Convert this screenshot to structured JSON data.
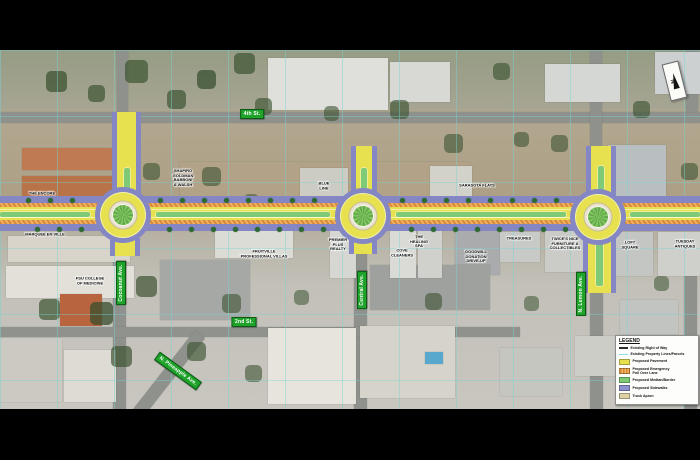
{
  "map": {
    "north_arrow_label": "N",
    "street_labels": [
      "4th St.",
      "2nd St.",
      "Cocoanut Ave.",
      "Central Ave.",
      "N. Lemon Ave.",
      "N. Pineapple Ave."
    ],
    "building_labels": [
      "THE ENCORE",
      "SHAPIRO\nGOLDMAN\nBABBONI\n& WALSH",
      "BLUE\nLINE",
      "SARASOTA FLATS",
      "MARQUEE EN VILLE",
      "FSU COLLEGE\nOF MEDICINE",
      "FRUITVILLE\nPROFESSIONAL VILLAS",
      "PREMIER\nPLUS\nREALTY",
      "COVE\nCLEANERS",
      "THE\nHEALING\nSPA",
      "GOODWILL\nDONATION\nDRIVE-UP",
      "TREASURES",
      "TWICE'S NICE\nFURNITURE &\nCOLLECTIBLES",
      "LOFT\nSQUARE",
      "TUESDAY\nANTIQUES"
    ]
  },
  "legend": {
    "title": "LEGEND",
    "items": [
      {
        "label": "Existing Right of Way",
        "swatch": "right-of-way"
      },
      {
        "label": "Existing Property Lines/Parcels",
        "swatch": "property-lines"
      },
      {
        "label": "Proposed Pavement",
        "swatch": "pavement"
      },
      {
        "label": "Proposed  Emergency\nPull Over Lane",
        "swatch": "emergency-lane"
      },
      {
        "label": "Proposed Median/Border",
        "swatch": "median"
      },
      {
        "label": "Proposed Sidewalks",
        "swatch": "sidewalks"
      },
      {
        "label": "Truck Apron",
        "swatch": "truck-apron"
      }
    ]
  },
  "colors": {
    "proposed_pavement": "#e7e14f",
    "proposed_sidewalks": "#8487c3",
    "proposed_median": "#7fca77",
    "emergency_lane": "#dd8c35",
    "truck_apron": "#e9e3cf",
    "property_lines": "#8fdcdc",
    "street_label_bg": "#1fa32a"
  }
}
